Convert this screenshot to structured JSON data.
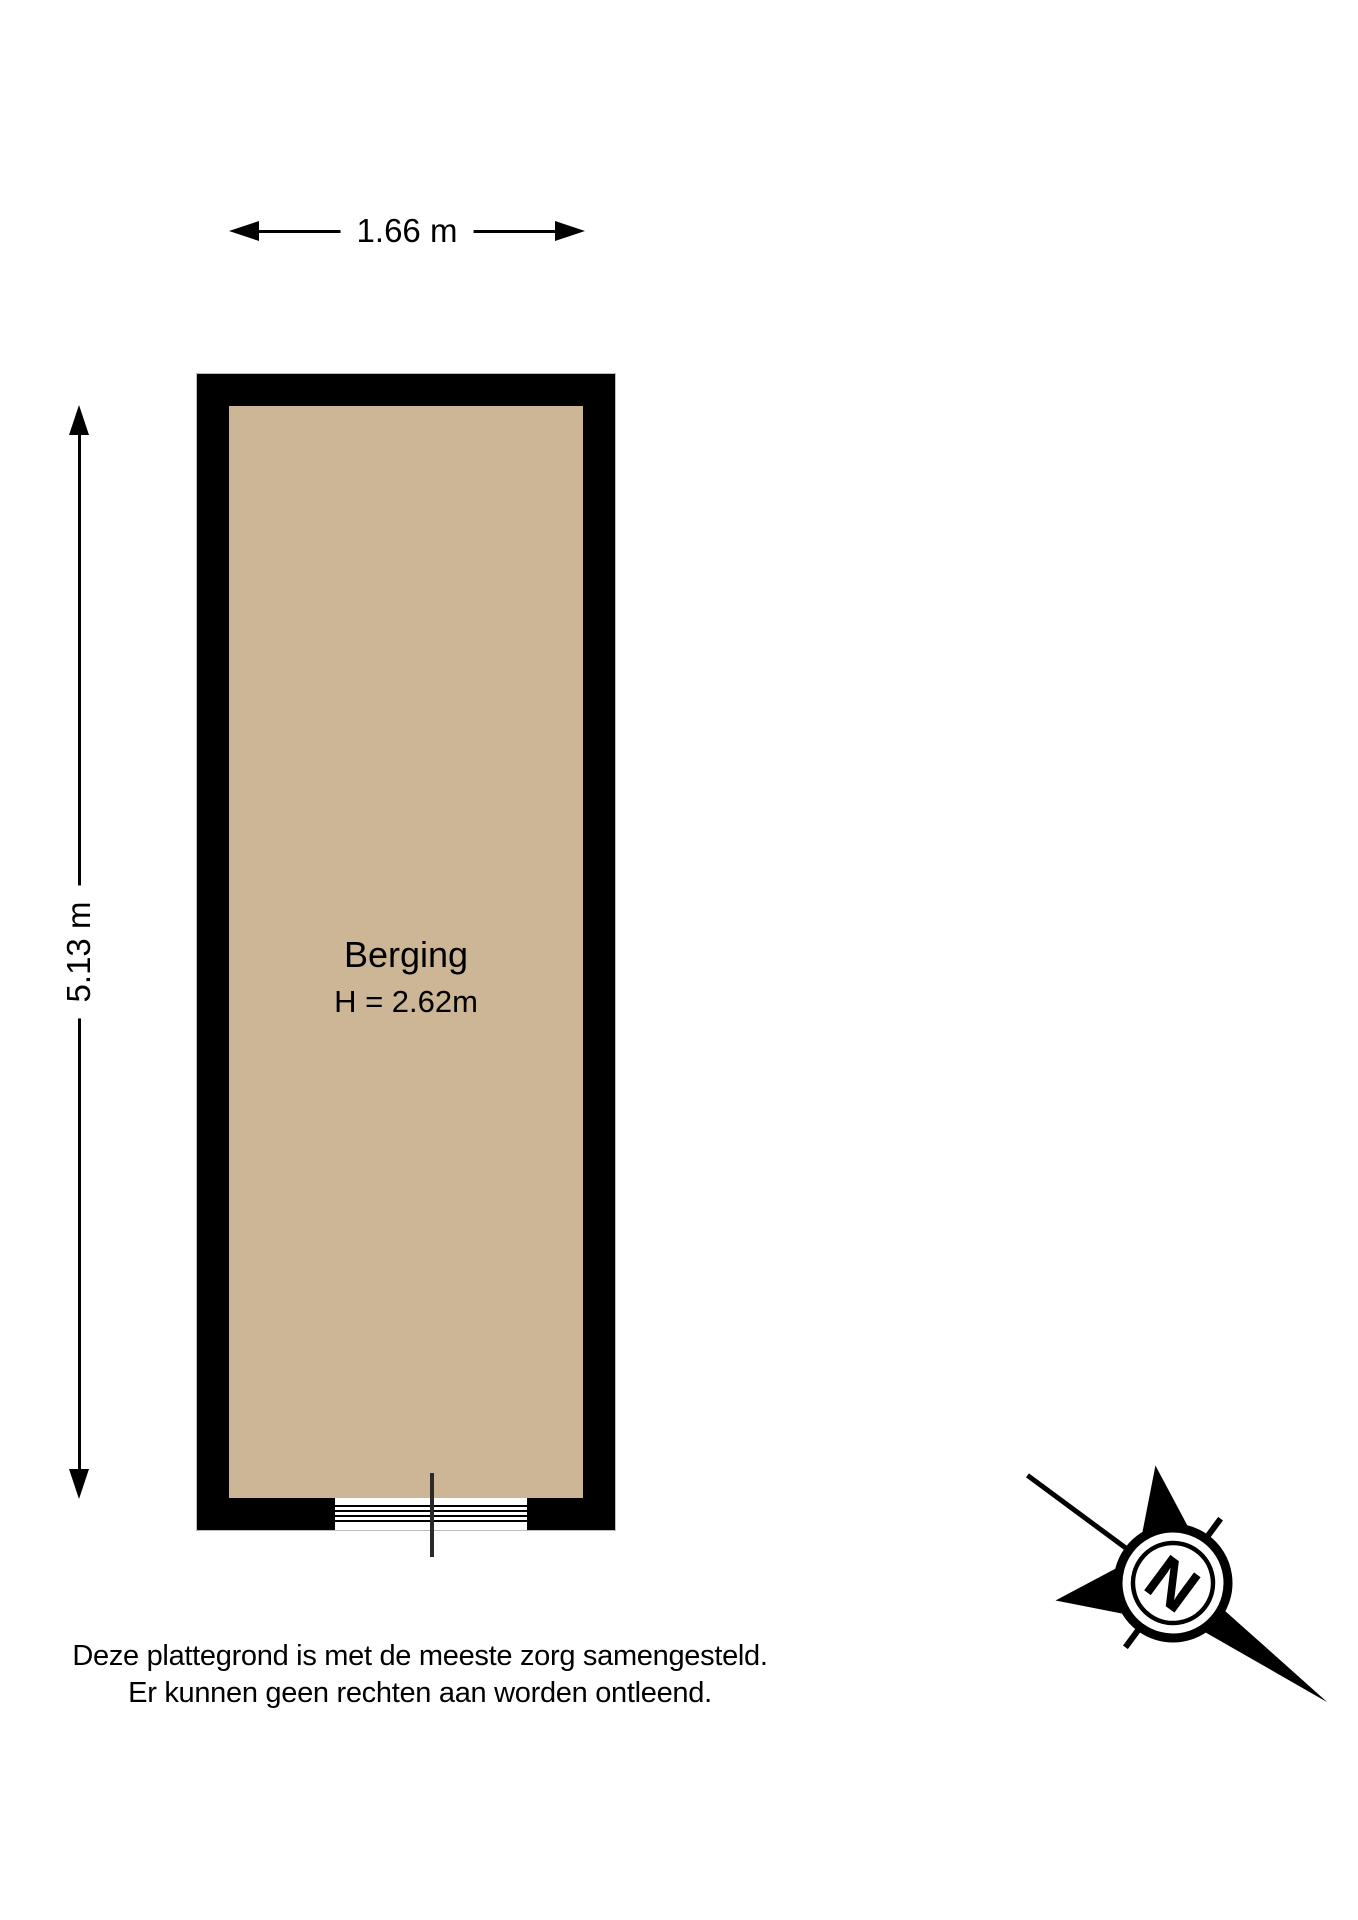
{
  "dimensions": {
    "width_label": "1.66 m",
    "height_label": "5.13 m"
  },
  "room": {
    "name": "Berging",
    "ceiling_height_label": "H = 2.62m",
    "floor_color": "#CCB696",
    "wall_color": "#000000"
  },
  "compass": {
    "north_label": "N"
  },
  "disclaimer": {
    "line1": "Deze plattegrond is met de meeste zorg samengesteld.",
    "line2": "Er kunnen geen rechten aan worden ontleend."
  }
}
